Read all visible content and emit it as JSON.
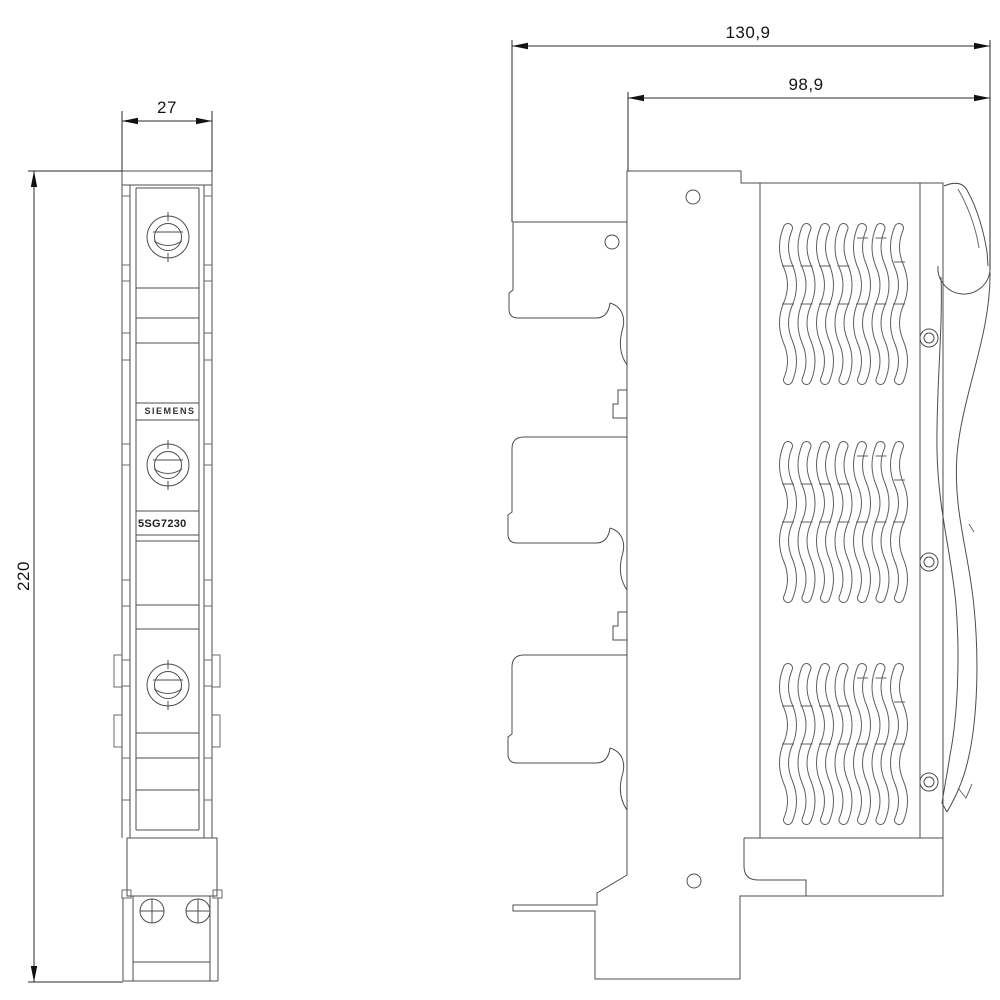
{
  "drawing": {
    "brand_label": "SIEMENS",
    "product_label": "5SG7230"
  },
  "dimensions": {
    "front_width_mm": "27",
    "front_height_mm": "220",
    "side_total_depth_mm": "130,9",
    "side_front_depth_mm": "98,9"
  },
  "colors": {
    "background": "#ffffff",
    "geometry_line": "#4d4d4d",
    "dimension_line": "#2a2a2a",
    "text": "#141414"
  }
}
